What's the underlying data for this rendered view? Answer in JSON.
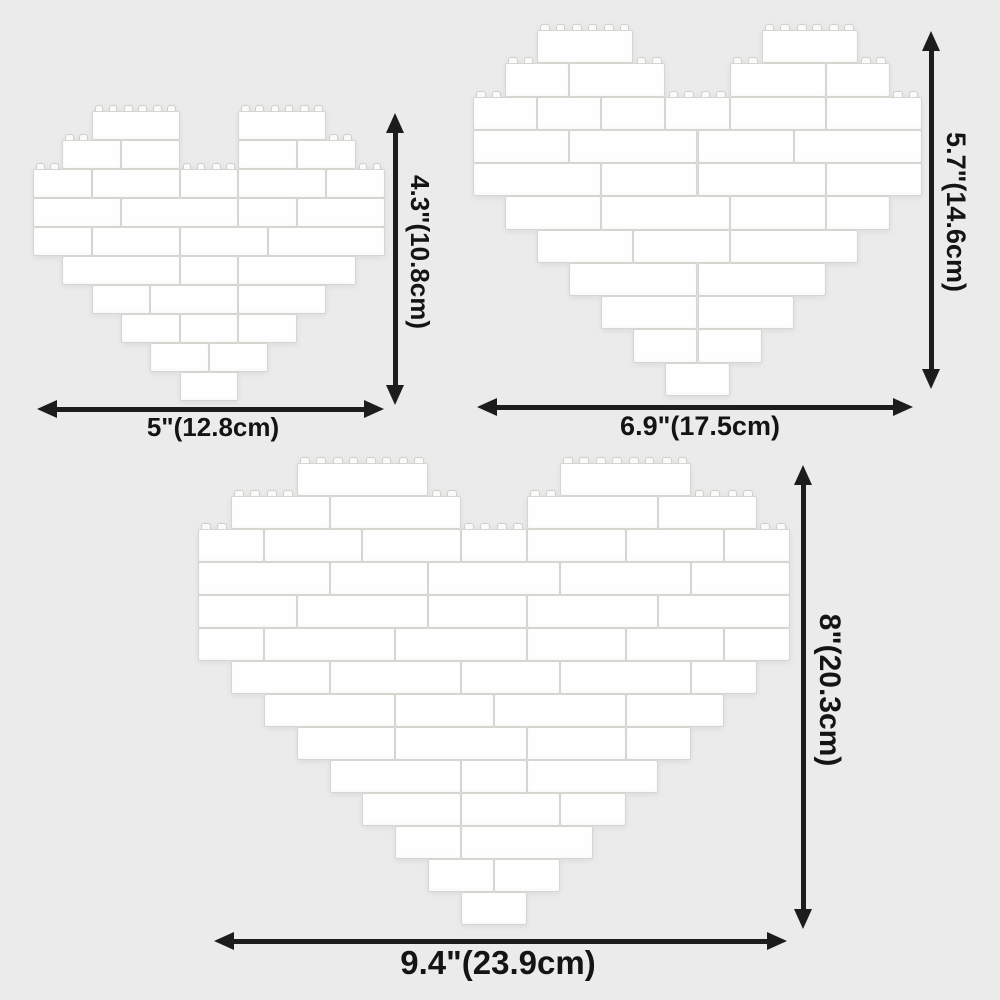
{
  "colors": {
    "background": "#ebebeb",
    "brick_fill": "#fefefe",
    "brick_edge": "#d8d5d0",
    "stud_fill": "#fafaf8",
    "stud_edge": "#d2cfca",
    "arrow": "#1c1c1c",
    "text": "#141414"
  },
  "hearts": [
    {
      "id": "small-brick-heart",
      "height_label": "4.3\"(10.8cm)",
      "width_label": "5\"(12.8cm)",
      "height_inches": "4.3\"",
      "height_cm": "10.8cm",
      "width_inches": "5\"",
      "width_cm": "12.8cm",
      "cols": 12,
      "rows": 10,
      "bricks": [
        [
          [
            2,
            3
          ],
          [
            7,
            3
          ]
        ],
        [
          [
            1,
            2
          ],
          [
            3,
            2
          ],
          [
            7,
            2
          ],
          [
            9,
            2
          ]
        ],
        [
          [
            0,
            2
          ],
          [
            2,
            3
          ],
          [
            5,
            2
          ],
          [
            7,
            3
          ],
          [
            10,
            2
          ]
        ],
        [
          [
            0,
            3
          ],
          [
            3,
            4
          ],
          [
            7,
            2
          ],
          [
            9,
            3
          ]
        ],
        [
          [
            0,
            2
          ],
          [
            2,
            3
          ],
          [
            5,
            3
          ],
          [
            8,
            4
          ]
        ],
        [
          [
            1,
            4
          ],
          [
            5,
            2
          ],
          [
            7,
            4
          ]
        ],
        [
          [
            2,
            2
          ],
          [
            4,
            3
          ],
          [
            7,
            3
          ]
        ],
        [
          [
            3,
            2
          ],
          [
            5,
            2
          ],
          [
            7,
            2
          ]
        ],
        [
          [
            4,
            2
          ],
          [
            6,
            2
          ]
        ],
        [
          [
            5,
            2
          ]
        ]
      ],
      "layout": {
        "box": {
          "left": 33,
          "top": 111,
          "width": 352,
          "height": 290
        },
        "v_arrow": {
          "x": 395,
          "y1": 113,
          "y2": 405
        },
        "v_label": {
          "x": 404,
          "center_y": 252
        },
        "h_arrow": {
          "y": 409,
          "x1": 37,
          "x2": 384
        },
        "h_label": {
          "center_x": 213,
          "top": 412
        }
      }
    },
    {
      "id": "medium-brick-heart",
      "height_label": "5.7\"(14.6cm)",
      "width_label": "6.9\"(17.5cm)",
      "height_inches": "5.7\"",
      "height_cm": "14.6cm",
      "width_inches": "6.9\"",
      "width_cm": "17.5cm",
      "cols": 14,
      "rows": 11,
      "bricks": [
        [
          [
            2,
            3
          ],
          [
            9,
            3
          ]
        ],
        [
          [
            1,
            2
          ],
          [
            3,
            3
          ],
          [
            8,
            3
          ],
          [
            11,
            2
          ]
        ],
        [
          [
            0,
            2
          ],
          [
            2,
            2
          ],
          [
            4,
            2
          ],
          [
            6,
            2
          ],
          [
            8,
            3
          ],
          [
            11,
            3
          ]
        ],
        [
          [
            0,
            3
          ],
          [
            3,
            4
          ],
          [
            7,
            3
          ],
          [
            10,
            4
          ]
        ],
        [
          [
            0,
            4
          ],
          [
            4,
            3
          ],
          [
            7,
            4
          ],
          [
            11,
            3
          ]
        ],
        [
          [
            1,
            3
          ],
          [
            4,
            4
          ],
          [
            8,
            3
          ],
          [
            11,
            2
          ]
        ],
        [
          [
            2,
            3
          ],
          [
            5,
            3
          ],
          [
            8,
            4
          ]
        ],
        [
          [
            3,
            4
          ],
          [
            7,
            4
          ]
        ],
        [
          [
            4,
            3
          ],
          [
            7,
            3
          ]
        ],
        [
          [
            5,
            2
          ],
          [
            7,
            2
          ]
        ],
        [
          [
            6,
            2
          ]
        ]
      ],
      "layout": {
        "box": {
          "left": 473,
          "top": 30,
          "width": 449,
          "height": 366
        },
        "v_arrow": {
          "x": 931,
          "y1": 31,
          "y2": 389
        },
        "v_label": {
          "x": 940,
          "center_y": 212
        },
        "h_arrow": {
          "y": 407,
          "x1": 477,
          "x2": 913
        },
        "h_label": {
          "center_x": 700,
          "top": 411
        }
      }
    },
    {
      "id": "large-brick-heart",
      "height_label": "8\"(20.3cm)",
      "width_label": "9.4\"(23.9cm)",
      "height_inches": "8\"",
      "height_cm": "20.3cm",
      "width_inches": "9.4\"",
      "width_cm": "23.9cm",
      "cols": 18,
      "rows": 14,
      "bricks": [
        [
          [
            3,
            4
          ],
          [
            11,
            4
          ]
        ],
        [
          [
            1,
            3
          ],
          [
            4,
            4
          ],
          [
            10,
            4
          ],
          [
            14,
            3
          ]
        ],
        [
          [
            0,
            2
          ],
          [
            2,
            3
          ],
          [
            5,
            3
          ],
          [
            8,
            2
          ],
          [
            10,
            3
          ],
          [
            13,
            3
          ],
          [
            16,
            2
          ]
        ],
        [
          [
            0,
            4
          ],
          [
            4,
            3
          ],
          [
            7,
            4
          ],
          [
            11,
            4
          ],
          [
            15,
            3
          ]
        ],
        [
          [
            0,
            3
          ],
          [
            3,
            4
          ],
          [
            7,
            3
          ],
          [
            10,
            4
          ],
          [
            14,
            4
          ]
        ],
        [
          [
            0,
            2
          ],
          [
            2,
            4
          ],
          [
            6,
            4
          ],
          [
            10,
            3
          ],
          [
            13,
            3
          ],
          [
            16,
            2
          ]
        ],
        [
          [
            1,
            3
          ],
          [
            4,
            4
          ],
          [
            8,
            3
          ],
          [
            11,
            4
          ],
          [
            15,
            2
          ]
        ],
        [
          [
            2,
            4
          ],
          [
            6,
            3
          ],
          [
            9,
            4
          ],
          [
            13,
            3
          ]
        ],
        [
          [
            3,
            3
          ],
          [
            6,
            4
          ],
          [
            10,
            3
          ],
          [
            13,
            2
          ]
        ],
        [
          [
            4,
            4
          ],
          [
            8,
            2
          ],
          [
            10,
            4
          ]
        ],
        [
          [
            5,
            3
          ],
          [
            8,
            3
          ],
          [
            11,
            2
          ]
        ],
        [
          [
            6,
            2
          ],
          [
            8,
            4
          ]
        ],
        [
          [
            7,
            2
          ],
          [
            9,
            2
          ]
        ],
        [
          [
            8,
            2
          ]
        ]
      ],
      "layout": {
        "box": {
          "left": 198,
          "top": 463,
          "width": 592,
          "height": 462
        },
        "v_arrow": {
          "x": 803,
          "y1": 465,
          "y2": 929
        },
        "v_label": {
          "x": 812,
          "center_y": 690
        },
        "h_arrow": {
          "y": 941,
          "x1": 214,
          "x2": 787
        },
        "h_label": {
          "center_x": 498,
          "top": 944
        }
      }
    }
  ]
}
